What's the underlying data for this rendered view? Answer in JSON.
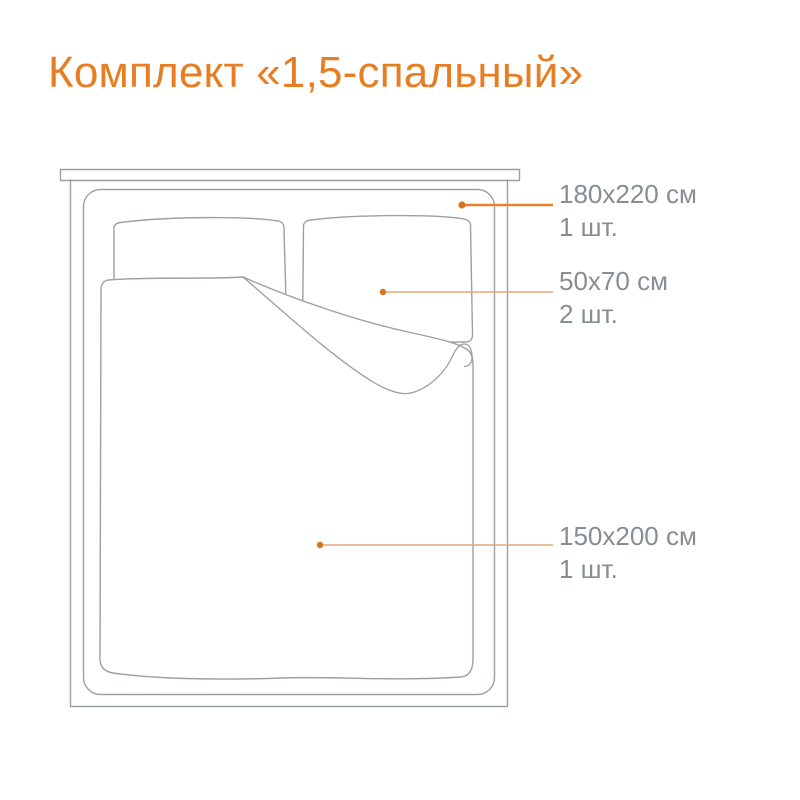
{
  "title": "Комплект «1,5-спальный»",
  "colors": {
    "background": "#FFFFFF",
    "title": "#E87E24",
    "leader_bold": "#E8822B",
    "leader_light": "#E3A876",
    "dot": "#D9741F",
    "outline": "#9AA0A6",
    "label_text": "#878D94"
  },
  "callouts": [
    {
      "size": "180х220 см",
      "qty": "1 шт."
    },
    {
      "size": "50х70 см",
      "qty": "2 шт."
    },
    {
      "size": "150х200 см",
      "qty": "1 шт."
    }
  ]
}
